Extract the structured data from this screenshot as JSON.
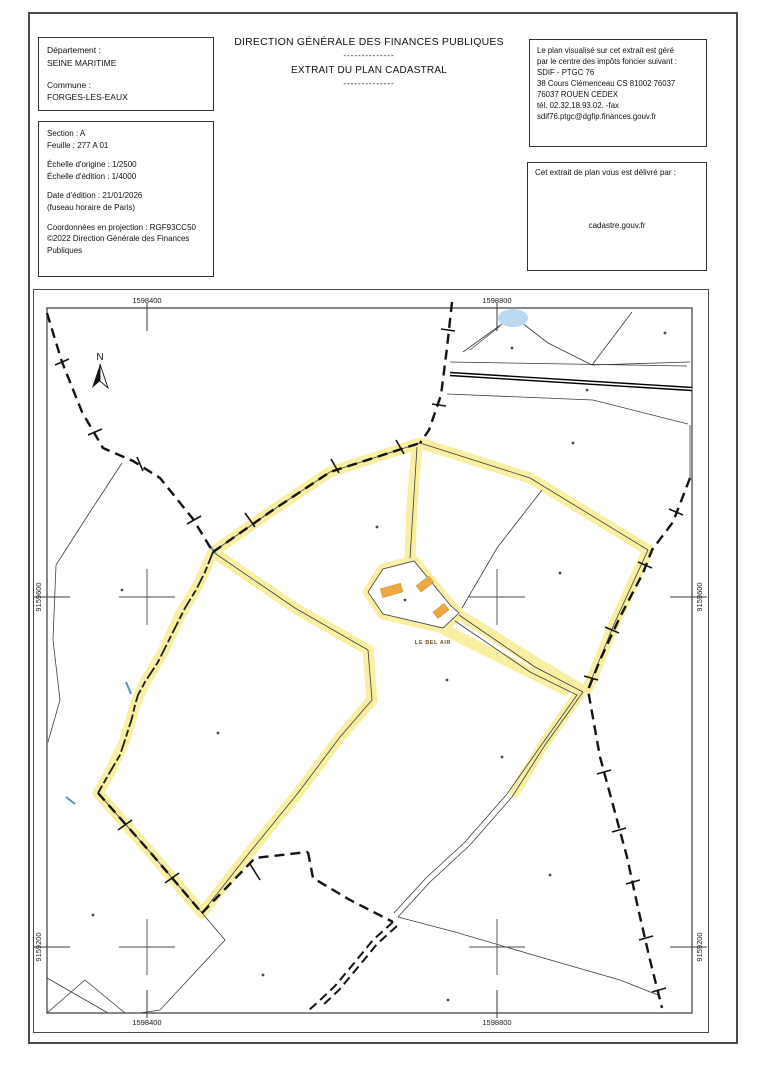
{
  "header": {
    "commune_box": {
      "departement_label": "Département :",
      "departement": "SEINE MARITIME",
      "commune_label": "Commune :",
      "commune": "FORGES-LES-EAUX"
    },
    "title_block": {
      "line1": "DIRECTION GÉNÉRALE DES FINANCES PUBLIQUES",
      "separator1": "--------------",
      "line2": "EXTRAIT DU PLAN CADASTRAL",
      "separator2": "--------------"
    },
    "info_box": {
      "lines": [
        "Section : A",
        "Feuille : 277 A 01",
        "Échelle d'origine : 1/2500",
        "Échelle d'édition : 1/4000",
        "Date d'édition : 21/01/2026",
        "(fuseau horaire de Paris)",
        "Coordonnées en projection : RGF93CC50",
        "©2022 Direction Générale des Finances",
        "Publiques"
      ]
    },
    "issuer_box": {
      "lines": [
        "Le plan visualisé sur cet extrait est géré",
        "par le centre des impôts foncier suivant :",
        "SDIF - PTGC 76",
        "38 Cours Clémenceau CS 81002 76037",
        "76037 ROUEN CEDEX",
        "tél. 02.32.18.93.02. -fax",
        "sdif76.ptgc@dgfip.finances.gouv.fr"
      ]
    },
    "delivery_box": {
      "intro": "Cet extrait de plan vous est délivré par :",
      "source": "cadastre.gouv.fr"
    }
  },
  "map": {
    "north_label": "N",
    "place_label": "LE BEL AIR",
    "coordinates": {
      "top": [
        "1598400",
        "1598800"
      ],
      "bottom": [
        "1598400",
        "1598800"
      ],
      "left": [
        "9159600",
        "9159200"
      ],
      "right": [
        "9159600",
        "9159200"
      ]
    },
    "colors": {
      "highlight_yellow": "#f8ef9e",
      "building_orange": "#eda93f",
      "water_blue": "#b8d9f1",
      "boundary_black": "#141414",
      "parcel_line": "#3c3c3c"
    }
  }
}
